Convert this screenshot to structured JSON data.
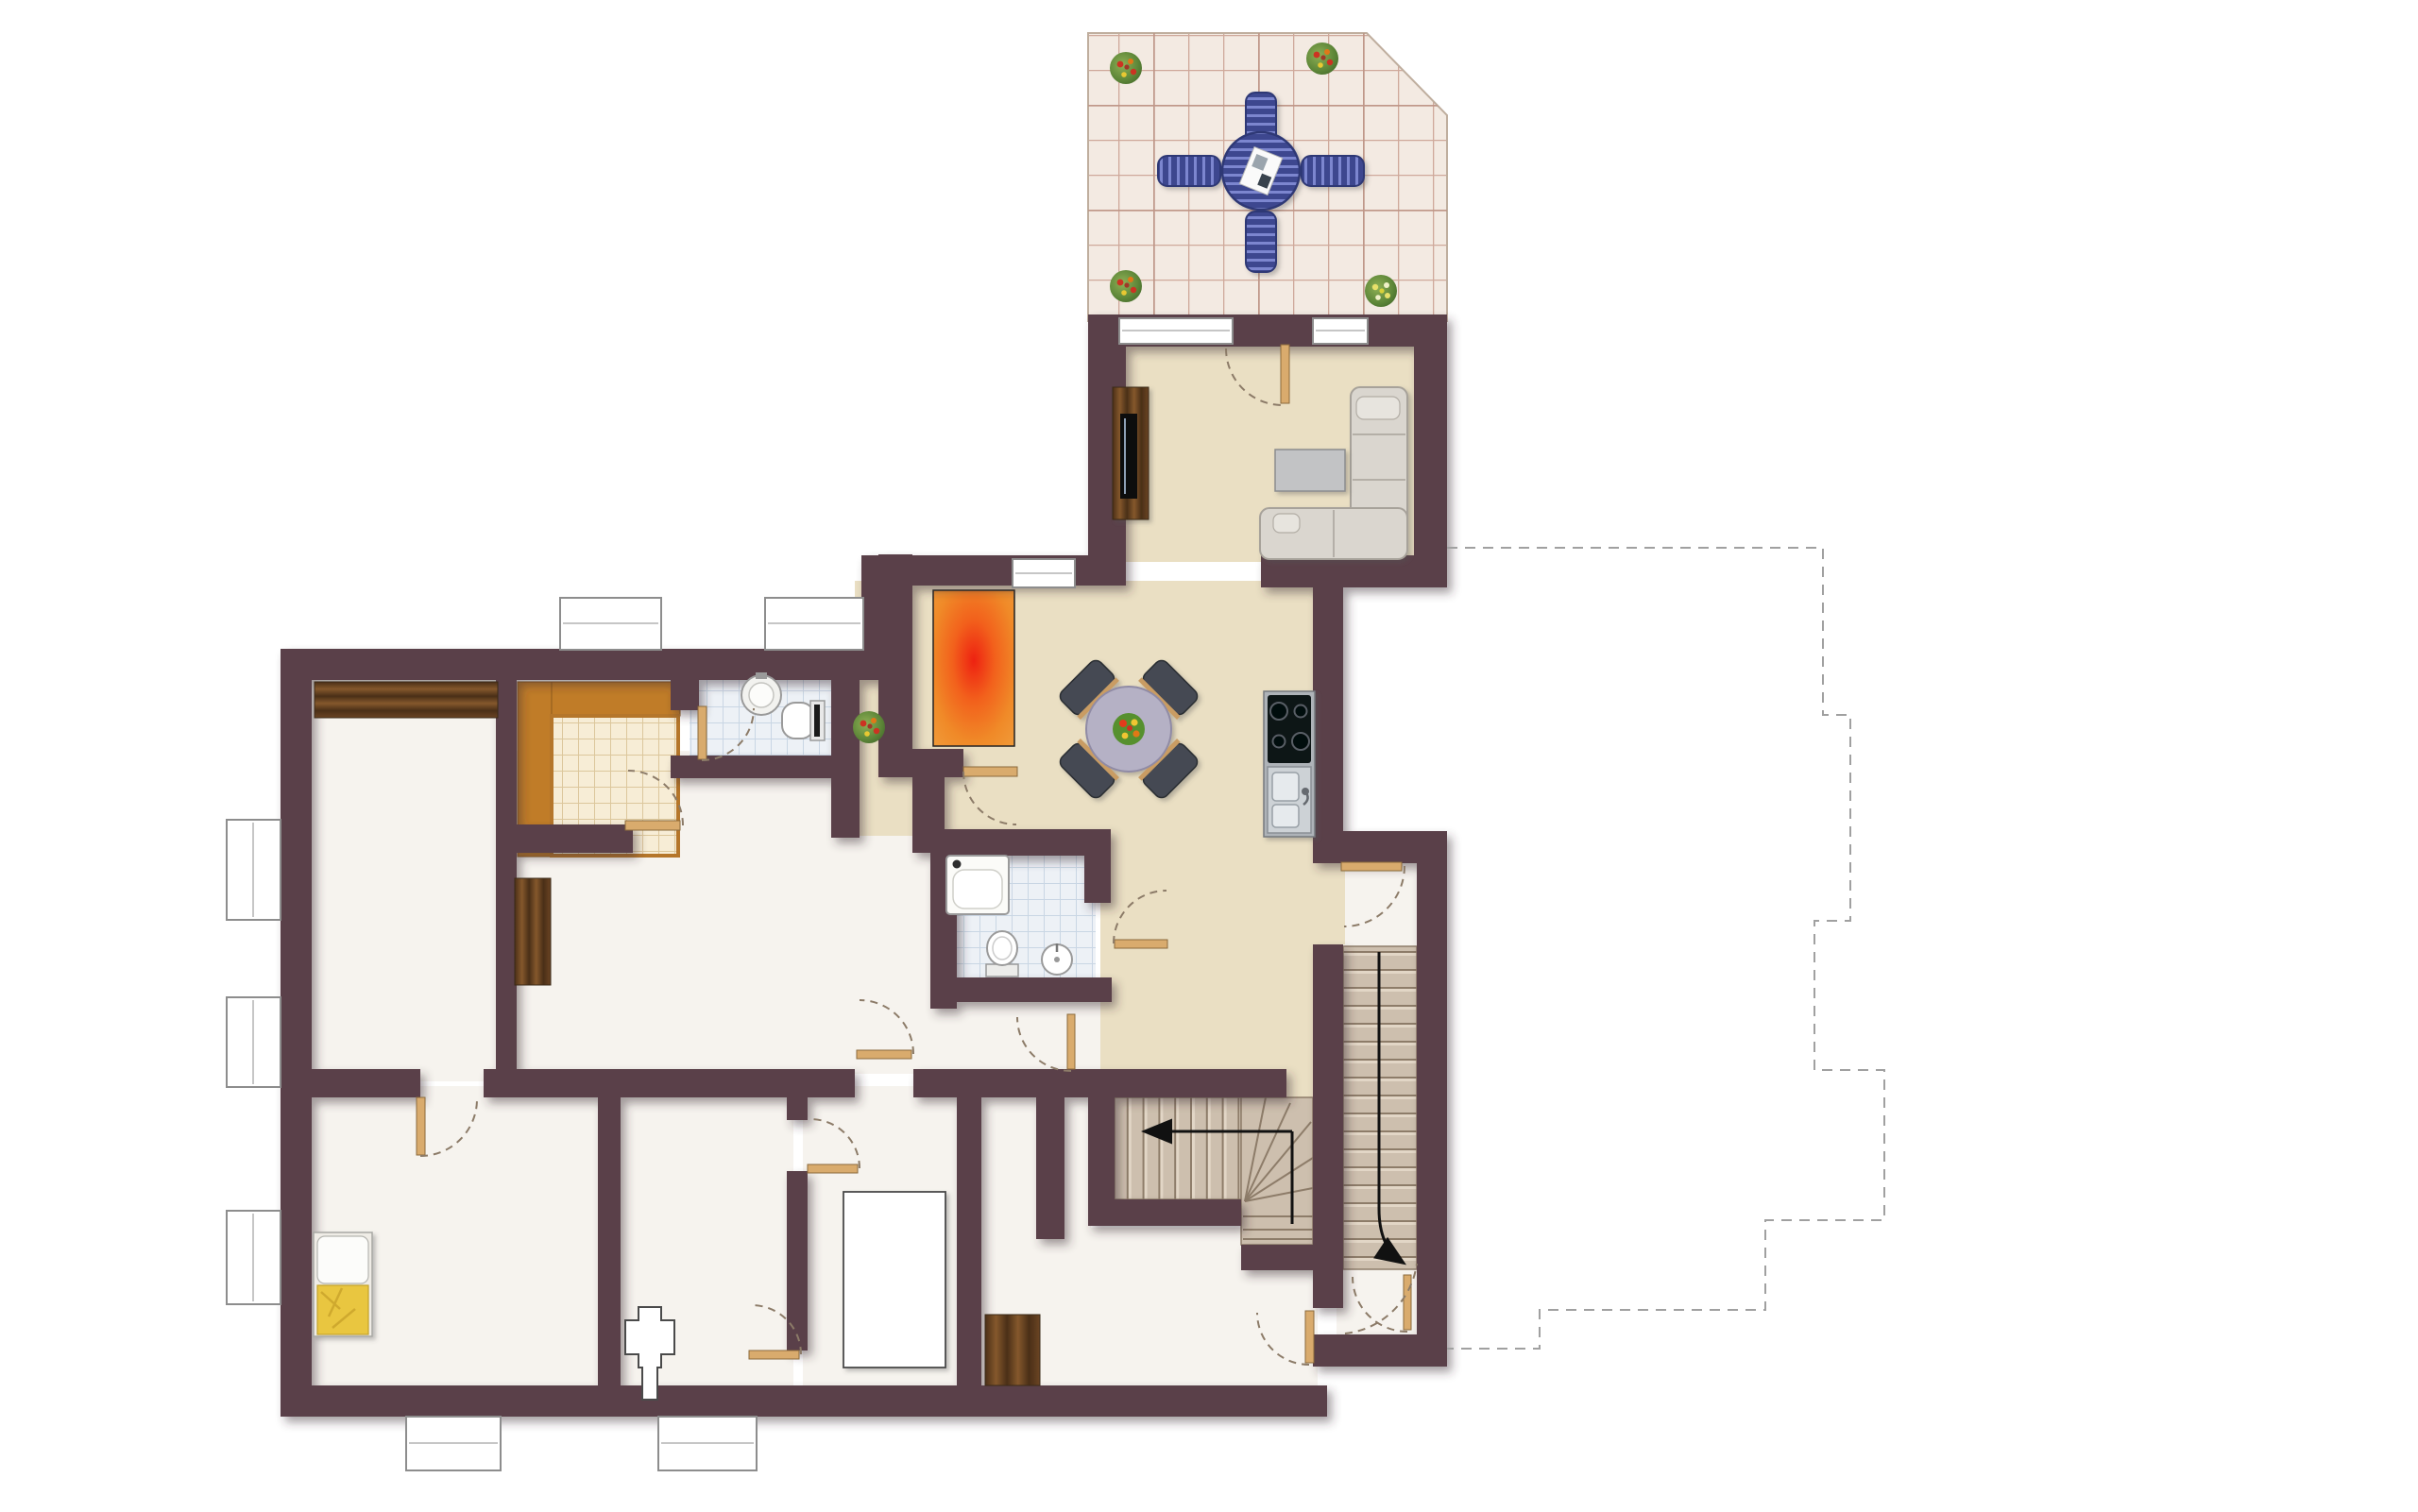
{
  "meta": {
    "title": "Apartment floor plan - ground floor",
    "description": "Rendered architectural floor plan: tiled terrace with blue patio set, living room with corner sofa and TV board, open kitchen and dining area, storage room with orange rug, pantry, WC, bathroom with tub, bedrooms, internal winder staircase, common building staircase and a dashed outline of the adjacent building section.",
    "visible_text_on_image": "none"
  },
  "palette": {
    "wall": "#5a4149",
    "floor_white": "#f6f3ee",
    "floor_beige": "#eadfc3",
    "terrace_tile": "#f3eae2",
    "terrace_grout": "#cfa99b",
    "bath_tile_floor": "#edf1f6",
    "bath_tile_line": "#c9d6e4",
    "pantry_tile": "#f7edd6",
    "pantry_frame": "#c07c28",
    "wood_dark": "#6b4423",
    "door_leaf": "#d9ab6d",
    "rug_orange": "#f08a28",
    "rug_center": "#ee2211",
    "stair_tread": "#cdbfae",
    "sofa": "#dad6cf",
    "patio_furniture_blue": "#4d58a8",
    "dining_table": "#b5b1c5",
    "dining_chair": "#454a52",
    "blanket_yellow": "#e9c63f",
    "arrow": "#111111",
    "dashed_outline": "#a0a0a0"
  },
  "rooms": [
    {
      "id": "terrace",
      "floor": "pink-beige tiles",
      "features": [
        "patio table",
        "4 blue chairs",
        "4 plant pots",
        "clipped corner top-right"
      ]
    },
    {
      "id": "living-room",
      "floor": "beige",
      "features": [
        "corner sofa",
        "coffee table",
        "tv-board",
        "terrace door",
        "2 windows"
      ]
    },
    {
      "id": "kitchen-dining",
      "floor": "beige",
      "features": [
        "round dining table",
        "4 chairs",
        "cooktop",
        "double sink"
      ]
    },
    {
      "id": "storage-room",
      "floor": "beige with orange rug",
      "features": [
        "window"
      ]
    },
    {
      "id": "pantry",
      "floor": "cream tile grid with orange wood frame",
      "features": [
        "door"
      ]
    },
    {
      "id": "wc",
      "floor": "blue tiles",
      "features": [
        "round washbasin",
        "toilet"
      ]
    },
    {
      "id": "bathroom",
      "floor": "blue tiles",
      "features": [
        "bathtub",
        "toilet",
        "washbasin"
      ]
    },
    {
      "id": "hallway",
      "floor": "beige",
      "features": [
        "plant"
      ]
    },
    {
      "id": "bedroom-top-left",
      "floor": "white",
      "features": [
        "wardrobe along top wall",
        "2 side windows"
      ]
    },
    {
      "id": "bedroom-bottom-left",
      "floor": "white",
      "features": [
        "single bed with yellow blanket",
        "door"
      ]
    },
    {
      "id": "room-center-bottom",
      "floor": "white",
      "features": [
        "chimney flue symbol"
      ]
    },
    {
      "id": "room-with-cabinet",
      "floor": "white",
      "features": [
        "large white cabinet"
      ]
    },
    {
      "id": "corridor-bottom",
      "floor": "white with wood strip",
      "features": []
    },
    {
      "id": "room-bottom-right",
      "floor": "white",
      "features": [
        "doors"
      ]
    },
    {
      "id": "internal-winder-stairs",
      "treads": 14,
      "arrow": "left"
    },
    {
      "id": "building-stairwell",
      "treads": 18,
      "arrow": "curved down-right",
      "features": [
        "entry door",
        "bottom landing door",
        "swing arcs"
      ]
    }
  ],
  "openings": {
    "doors": 13,
    "windows": 10
  },
  "plants": 5,
  "dashed_outline": {
    "meaning": "adjacent building section (not part of apartment)",
    "path": "1532,580 H1930 V757 H1959 V975 H1921 V1133 H1995 V1292 H1869 V1387 H1630 V1428 H1532"
  }
}
